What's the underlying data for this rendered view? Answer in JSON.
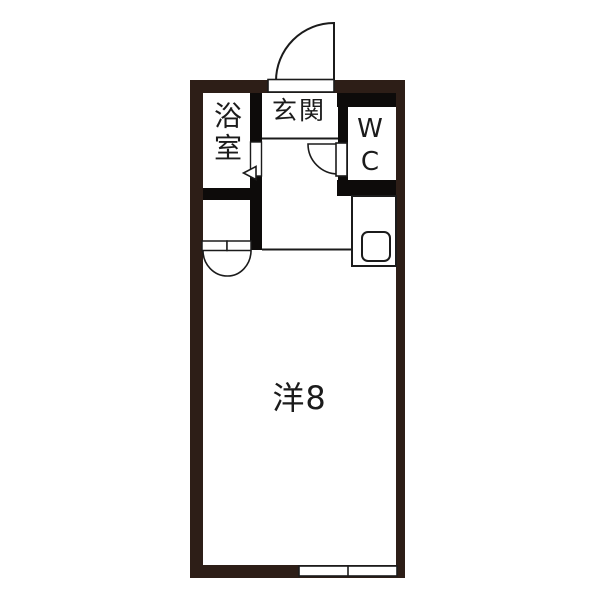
{
  "floor_plan": {
    "type": "apartment-floor-plan",
    "rooms": {
      "bathroom": {
        "label": "浴室"
      },
      "entrance": {
        "label": "玄関"
      },
      "toilet": {
        "label": "WC"
      },
      "main_room": {
        "label": "洋8"
      }
    },
    "fixtures": {
      "entrance_door": "hinged-door-swing",
      "toilet_door": "hinged-door-swing",
      "closet_doors": "double-door-swing",
      "bathroom_door": "sliding-door-with-arrow",
      "kitchen_counter": "counter-with-sink",
      "window": "two-pane-window"
    },
    "colors": {
      "outer_wall": "#2d1e17",
      "inner_wall": "#0d0b0a",
      "line": "#1b1b1b",
      "floor": "#ffffff"
    }
  }
}
